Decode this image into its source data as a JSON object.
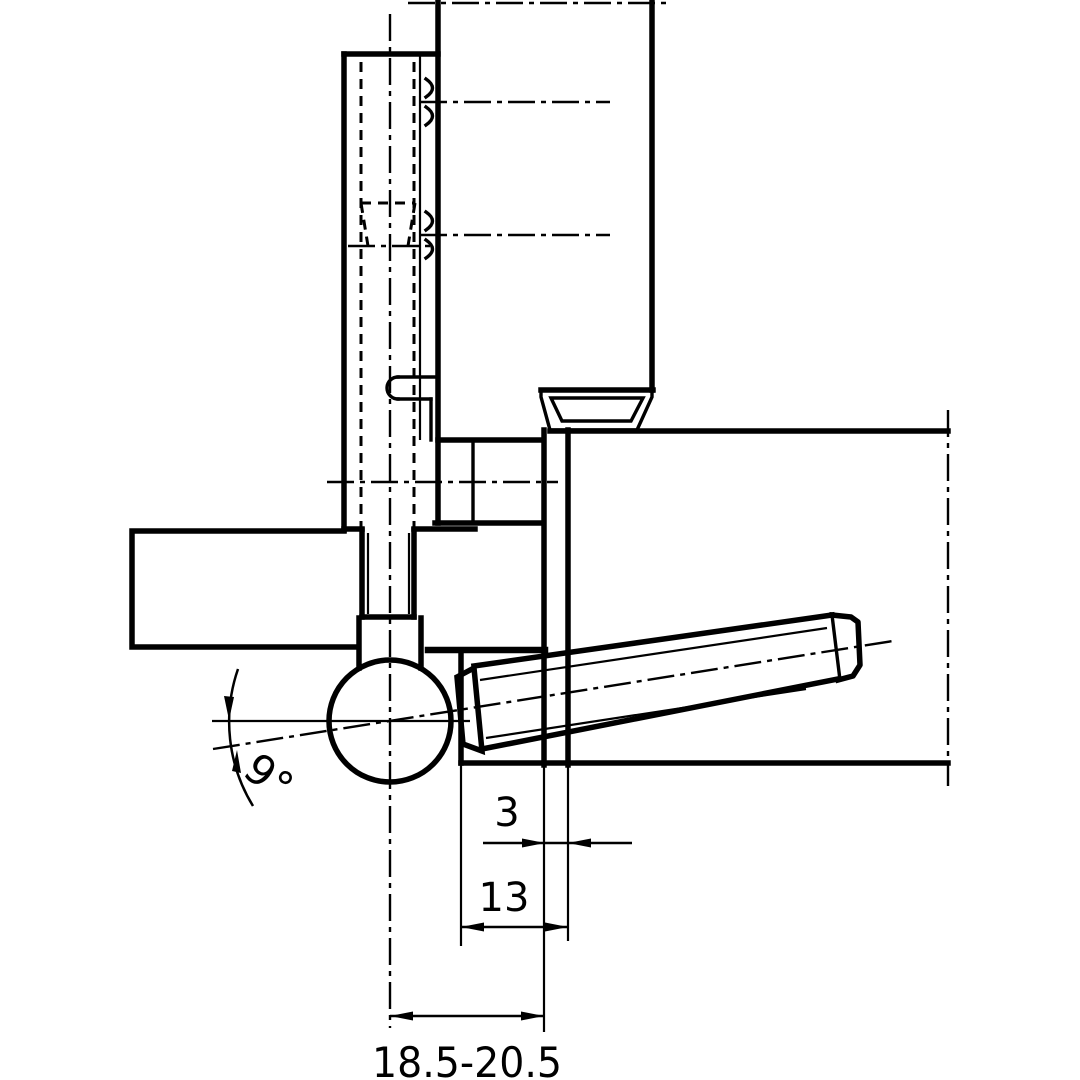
{
  "title": "Drill-in hinge installation cross-section",
  "drawing": {
    "angle_label": "9°",
    "rebate_gap_label": "3",
    "frame_overlap_label": "13",
    "drill_distance_label": "18.5-20.5",
    "line_color": "#000000",
    "background_color": "#ffffff"
  }
}
